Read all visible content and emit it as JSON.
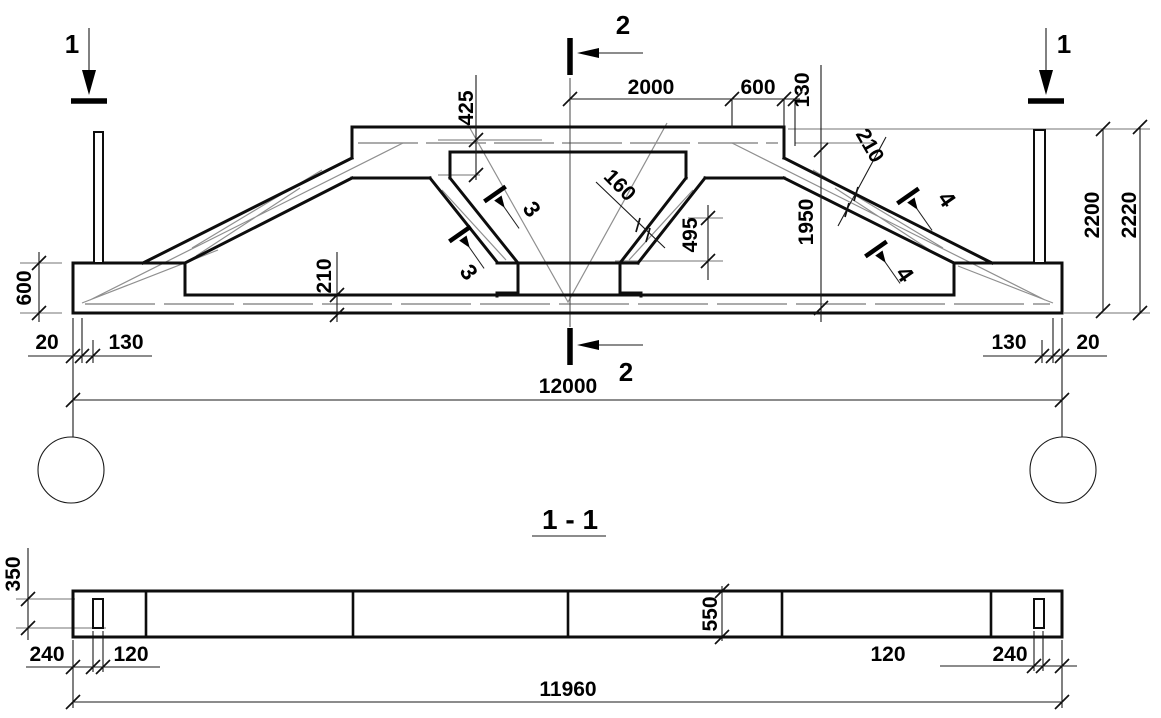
{
  "drawing_type": "truss elevation with section",
  "elevation": {
    "marker_1_left": "1",
    "marker_1_right": "1",
    "marker_2_top": "2",
    "marker_2_bottom": "2",
    "cut_3a": "3",
    "cut_3b": "3",
    "cut_4a": "4",
    "cut_4b": "4",
    "dims": {
      "top_offset": "425",
      "half_span_top": "2000",
      "top_end": "600",
      "top_step": "130",
      "diag_thickness": "210",
      "web_height": "1950",
      "height_chord": "2200",
      "height_overall": "2220",
      "web_thickness": "160",
      "node_depth": "495",
      "chord_thickness": "210",
      "support_height": "600",
      "gap_left": "20",
      "inset_left": "130",
      "inset_right": "130",
      "gap_right": "20",
      "span": "12000"
    }
  },
  "section": {
    "title": "1 - 1",
    "dims": {
      "slot_length": "350",
      "edge_left": "240",
      "slot_left": "120",
      "width": "550",
      "slot_right": "120",
      "edge_right": "240",
      "length": "11960"
    }
  }
}
